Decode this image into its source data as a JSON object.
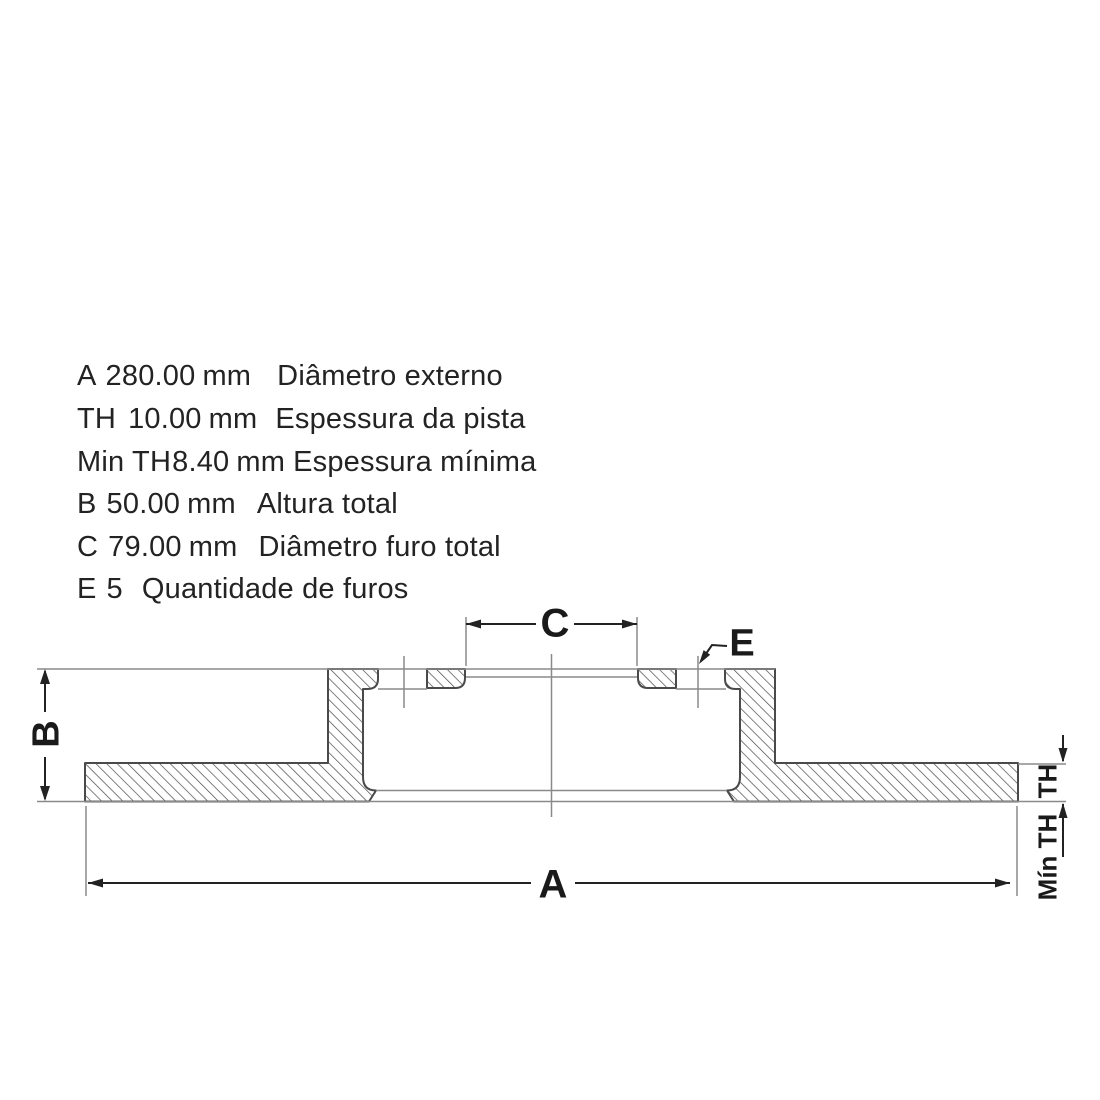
{
  "spec": {
    "rows": [
      {
        "key": "A",
        "value": "280.00",
        "unit": "mm",
        "description": "Diâmetro externo"
      },
      {
        "key": "TH",
        "value": "10.00",
        "unit": "mm",
        "description": "Espessura da pista"
      },
      {
        "key": "Min TH",
        "value": "8.40",
        "unit": "mm",
        "description": "Espessura mínima"
      },
      {
        "key": "B",
        "value": "50.00",
        "unit": "mm",
        "description": "Altura total"
      },
      {
        "key": "C",
        "value": "79.00",
        "unit": "mm",
        "description": "Diâmetro furo total"
      },
      {
        "key": "E",
        "value": "5",
        "description": "Quantidade de furos"
      }
    ]
  },
  "drawing": {
    "type": "brake-disc-cross-section",
    "dimension_labels": {
      "a": "A",
      "b": "B",
      "c": "C",
      "e": "E",
      "th": "TH",
      "min_th": "Mín TH"
    },
    "colors": {
      "background": "#ffffff",
      "ink": "#1a1a1a",
      "thin_line_gray": "#8a8a8a",
      "outline_gray": "#4a4a4a"
    }
  }
}
